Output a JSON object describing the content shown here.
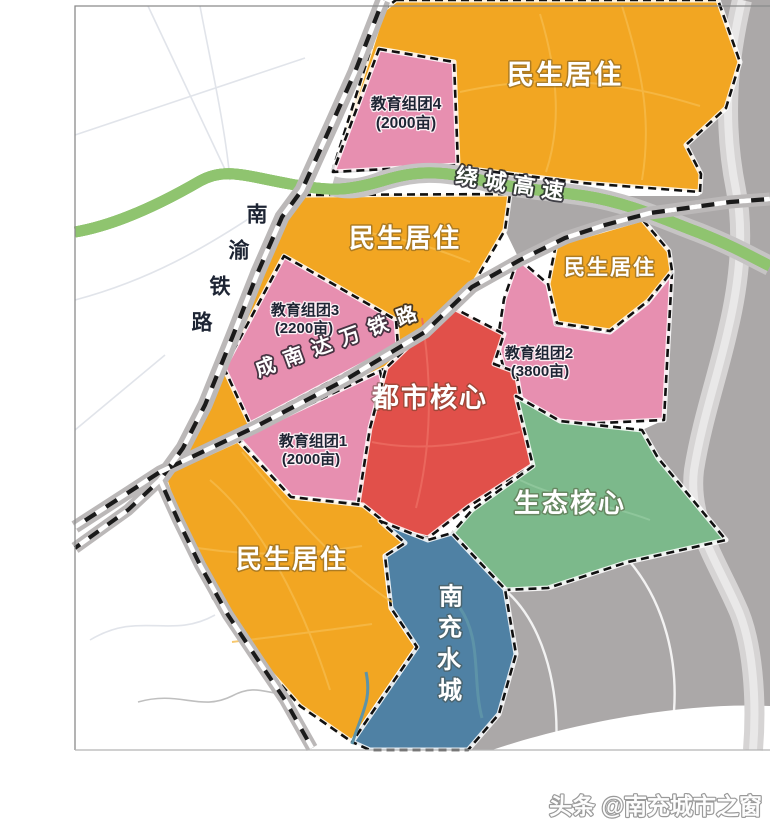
{
  "map": {
    "zone_labels": {
      "minsheng_top": "民生居住",
      "minsheng_mid": "民生居住",
      "minsheng_right": "民生居住",
      "minsheng_bottom": "民生居住",
      "edu4": {
        "name": "教育组团4",
        "area": "(2000亩)"
      },
      "edu3": {
        "name": "教育组团3",
        "area": "(2200亩)"
      },
      "edu2": {
        "name": "教育组团2",
        "area": "(3800亩)"
      },
      "edu1": {
        "name": "教育组团1",
        "area": "(2000亩)"
      },
      "urban_core": "都市核心",
      "eco_core": "生态核心",
      "water_city": {
        "chars": [
          "南",
          "充",
          "水",
          "城"
        ]
      }
    },
    "transport_labels": {
      "ring_expressway": "绕城高速",
      "nanyu_railway": {
        "chars": [
          "南",
          "渝",
          "铁",
          "路"
        ]
      },
      "chengnandawan_railway": "成南达万铁路"
    },
    "colors": {
      "residential": "#F2A622",
      "education": "#E78FB0",
      "urban_core": "#E1504A",
      "eco_core": "#7CB98B",
      "water_city": "#4F81A4",
      "built_area": "#ABA8A8",
      "river": "#D6D4D4",
      "expressway": "#8FC46F",
      "expressway_center": "#CC4F42",
      "railway": "#1A1A1A"
    }
  },
  "watermark": "头条 @南充城市之窗"
}
